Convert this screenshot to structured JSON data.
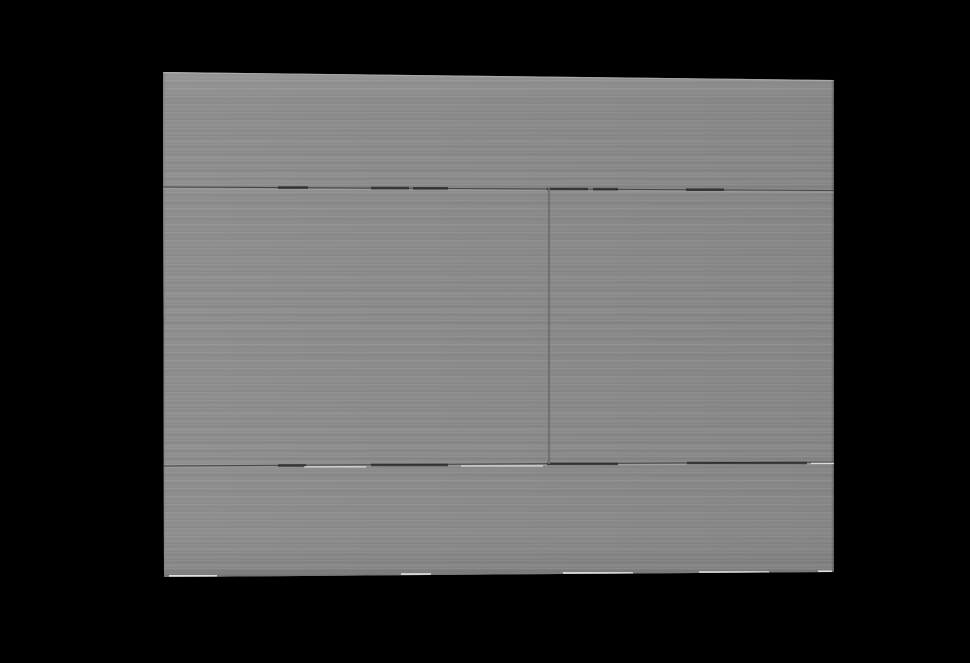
{
  "brand": {
    "text": "Iberica Blanca"
  },
  "colors": {
    "background": "#000000",
    "plate-base": "#8d8d8d",
    "plate-light": "#979797",
    "plate-dark": "#848484",
    "side-face": "#7d7d7d",
    "seam": "#2e2e2e",
    "seam-soft": "#6e6e6e",
    "edge-highlight": "#f5f5f5",
    "brand-text": "#4a4a4a"
  }
}
